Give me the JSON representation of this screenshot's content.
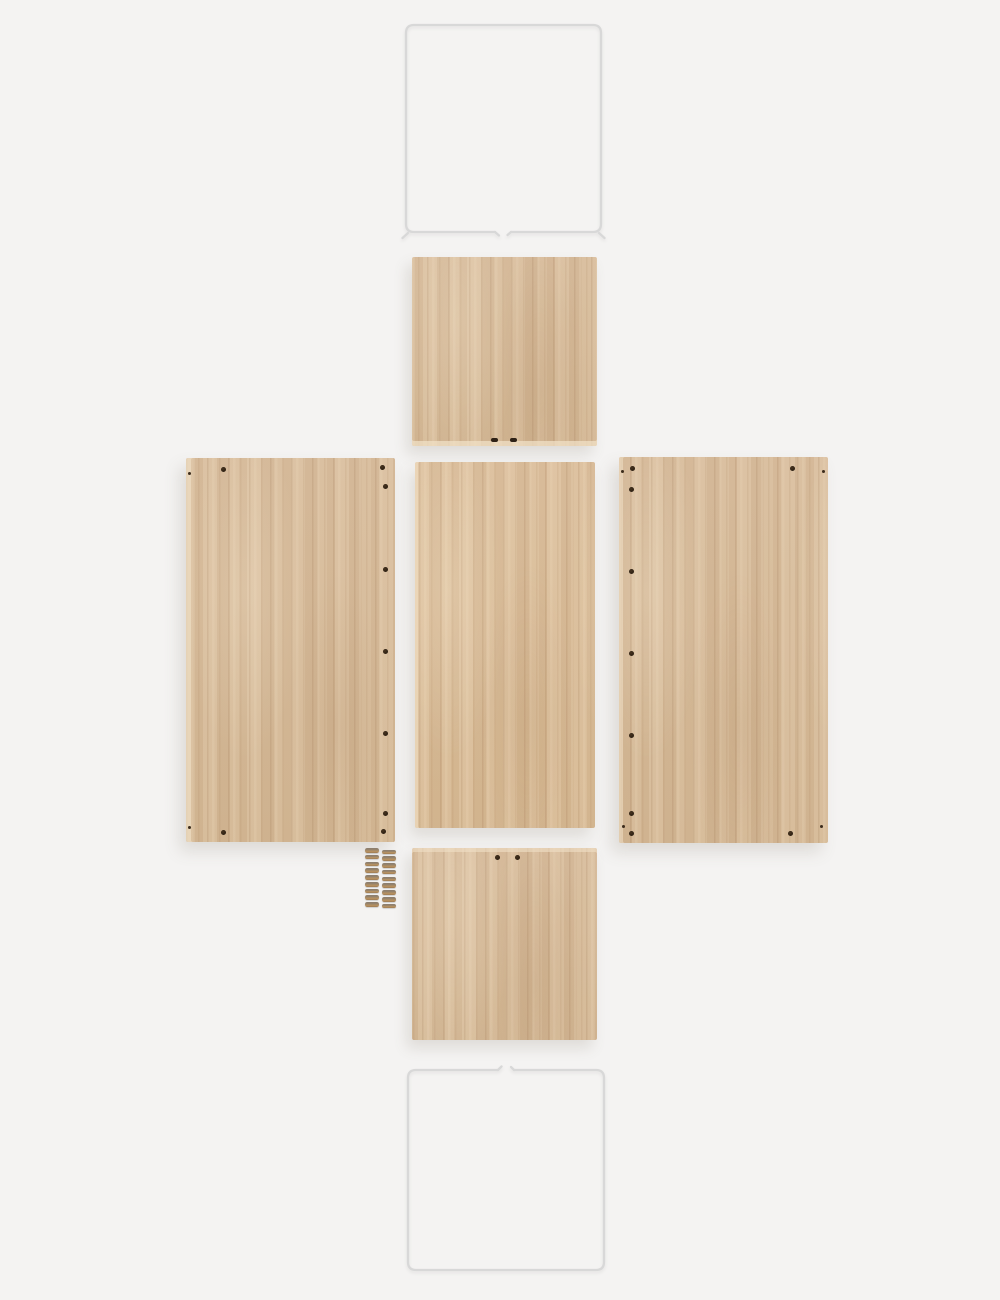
{
  "meta": {
    "description": "Flat-lay product photo of an unassembled oak storage-crate kit: two white wire frames, five pre-drilled oak panels, and two stacks of screws on a light gray background",
    "background_color": "#f4f3f2"
  },
  "palette": {
    "background": "#f4f3f2",
    "frame_line": "#d8d8d8",
    "wood_base": "#d5ba9b",
    "wood_light": "#e7d3b5",
    "wood_dark": "#bf9f7b",
    "wood_edge": "#f0e0c6",
    "hole": "#2e2116",
    "screw_head": "#8b7e6f",
    "screw_body": "#b99464"
  },
  "parts": {
    "frame_top": {
      "label": "white-wire-frame-top",
      "gap_side": "bottom"
    },
    "panel_top": {
      "label": "oak-shelf-panel-top",
      "holes": [
        {
          "x": 79,
          "y": 181,
          "t": "slot"
        },
        {
          "x": 98,
          "y": 181,
          "t": "slot"
        }
      ]
    },
    "panel_left": {
      "label": "oak-side-panel-left",
      "holes": [
        {
          "x": 35,
          "y": 9,
          "t": "round"
        },
        {
          "x": 2,
          "y": 14,
          "t": "small"
        },
        {
          "x": 194,
          "y": 7,
          "t": "round"
        },
        {
          "x": 197,
          "y": 26,
          "t": "round"
        },
        {
          "x": 197,
          "y": 109,
          "t": "round"
        },
        {
          "x": 197,
          "y": 191,
          "t": "round"
        },
        {
          "x": 197,
          "y": 273,
          "t": "round"
        },
        {
          "x": 197,
          "y": 353,
          "t": "round"
        },
        {
          "x": 195,
          "y": 371,
          "t": "round"
        },
        {
          "x": 35,
          "y": 372,
          "t": "round"
        },
        {
          "x": 2,
          "y": 368,
          "t": "small"
        }
      ]
    },
    "panel_mid": {
      "label": "oak-middle-panel",
      "holes": []
    },
    "panel_right": {
      "label": "oak-side-panel-right",
      "holes": [
        {
          "x": 11,
          "y": 9,
          "t": "round"
        },
        {
          "x": 2,
          "y": 13,
          "t": "small"
        },
        {
          "x": 10,
          "y": 30,
          "t": "round"
        },
        {
          "x": 10,
          "y": 112,
          "t": "round"
        },
        {
          "x": 10,
          "y": 194,
          "t": "round"
        },
        {
          "x": 10,
          "y": 276,
          "t": "round"
        },
        {
          "x": 10,
          "y": 354,
          "t": "round"
        },
        {
          "x": 3,
          "y": 368,
          "t": "small"
        },
        {
          "x": 10,
          "y": 374,
          "t": "round"
        },
        {
          "x": 171,
          "y": 9,
          "t": "round"
        },
        {
          "x": 203,
          "y": 13,
          "t": "small"
        },
        {
          "x": 169,
          "y": 374,
          "t": "round"
        },
        {
          "x": 201,
          "y": 368,
          "t": "small"
        }
      ]
    },
    "screws": {
      "label": "screw-stacks",
      "columns": 2,
      "per_column": 9
    },
    "panel_bottom": {
      "label": "oak-shelf-panel-bottom",
      "holes": [
        {
          "x": 83,
          "y": 7,
          "t": "round"
        },
        {
          "x": 103,
          "y": 7,
          "t": "round"
        }
      ]
    },
    "frame_bottom": {
      "label": "white-wire-frame-bottom",
      "gap_side": "top"
    }
  }
}
